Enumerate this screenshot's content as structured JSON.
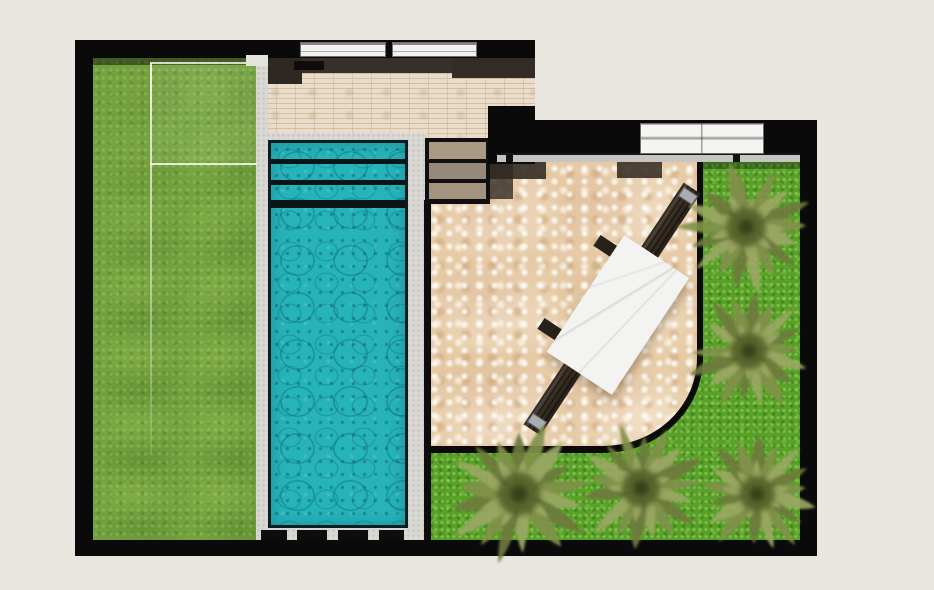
{
  "scene": {
    "kind": "architectural-landscape-plan-top-view",
    "background": "#e9e5df"
  },
  "palette": {
    "background": "#e9e5df",
    "wall": "#0a0a0a",
    "lawn": "#73a33e",
    "grass": "#57a226",
    "pool_water": "#26b3ba",
    "coping": "#dad9d4",
    "brick": "#e9ddca",
    "patio_stone": "#e6cba6",
    "threshold": "#c6c5c1",
    "table": "#f3f4f2",
    "trunk": "#3c3126",
    "palm_dark": "#6d7a3c",
    "palm_mid": "#81904a",
    "palm_light": "#9aa763",
    "palm_center": "#46511f",
    "facade_shadow": "#37302a",
    "step_tan": "#a39580"
  },
  "layout": {
    "wall_left": [
      75,
      40,
      18,
      516
    ],
    "wall_top": [
      75,
      40,
      460,
      18
    ],
    "wall_bottom": [
      75,
      540,
      742,
      16
    ],
    "wall_right": [
      800,
      120,
      17,
      436
    ],
    "wall_wing_top": [
      490,
      120,
      327,
      42
    ],
    "wall_corner": [
      488,
      106,
      47,
      58
    ],
    "lawn": [
      93,
      58,
      164,
      482
    ],
    "lawn_shadow": [
      93,
      58,
      164,
      7
    ],
    "bed_overlay": [
      150,
      63,
      107,
      101
    ],
    "bed_line_v": [
      150,
      63,
      2,
      392
    ],
    "bed_line_top": [
      150,
      62,
      107,
      2
    ],
    "bed_line_h": [
      150,
      163,
      107,
      2
    ],
    "coping_upper": [
      256,
      56,
      12,
      80
    ],
    "corner_paver": [
      246,
      55,
      22,
      11
    ],
    "brick": [
      257,
      58,
      278,
      80
    ],
    "brick_sill": [
      257,
      133,
      170,
      5
    ],
    "pool_coping": [
      256,
      133,
      171,
      410
    ],
    "pool_water": [
      268,
      140,
      140,
      388
    ],
    "steps_block": [
      425,
      138,
      65,
      66
    ],
    "grass": [
      427,
      162,
      373,
      378
    ],
    "grass_top_shadow": [
      703,
      162,
      97,
      7
    ],
    "patio": [
      427,
      162,
      276,
      291
    ],
    "patio_edge_line": [
      424,
      200,
      7,
      340
    ],
    "threshold": [
      497,
      153,
      303,
      9
    ],
    "door_right": [
      640,
      123,
      124,
      31
    ],
    "door_top_1": [
      300,
      42,
      86,
      15
    ],
    "door_top_2": [
      392,
      42,
      85,
      15
    ]
  },
  "facade_shadows": [
    {
      "rect": [
        268,
        58,
        267,
        15
      ],
      "color": "#37302a"
    },
    {
      "rect": [
        268,
        58,
        34,
        26
      ],
      "color": "#2e2823"
    },
    {
      "rect": [
        452,
        58,
        83,
        20
      ],
      "color": "#332c26"
    },
    {
      "rect": [
        294,
        61,
        30,
        9
      ],
      "color": "#0f0d0b"
    }
  ],
  "patio_shadows": [
    {
      "rect": [
        490,
        162,
        56,
        17
      ],
      "color": "rgba(48,40,31,0.88)"
    },
    {
      "rect": [
        490,
        162,
        23,
        37
      ],
      "color": "rgba(48,40,31,0.80)"
    },
    {
      "rect": [
        617,
        162,
        45,
        16
      ],
      "color": "rgba(48,40,31,0.85)"
    }
  ],
  "pool": {
    "lane_lines": [
      {
        "y": 16,
        "h": 5
      },
      {
        "y": 37,
        "h": 5
      },
      {
        "y": 57,
        "h": 8
      }
    ],
    "bottom_dashes": [
      [
        261,
        530,
        26,
        10
      ],
      [
        297,
        530,
        30,
        10
      ],
      [
        338,
        530,
        30,
        10
      ],
      [
        379,
        530,
        25,
        10
      ]
    ],
    "step_treads": [
      {
        "rect": [
          429,
          142,
          57,
          17
        ],
        "color": "#a89a85"
      },
      {
        "rect": [
          429,
          163,
          57,
          16
        ],
        "color": "#97897a"
      },
      {
        "rect": [
          429,
          183,
          57,
          16
        ],
        "color": "#a2947e"
      }
    ]
  },
  "door_stops": [
    [
      506,
      154,
      7,
      8
    ],
    [
      733,
      154,
      7,
      8
    ]
  ],
  "furniture": {
    "trunk": {
      "cx": 612,
      "cy": 309,
      "w": 20,
      "h": 290,
      "rot": 33.5
    },
    "trunk_caps": [
      {
        "cx": 688,
        "cy": 196,
        "w": 17,
        "h": 11,
        "rot": 33.5
      },
      {
        "cx": 537,
        "cy": 422,
        "w": 17,
        "h": 11,
        "rot": 33.5
      }
    ],
    "side_stubs": [
      {
        "cx": 607,
        "cy": 247,
        "w": 24,
        "h": 13,
        "rot": 33.5
      },
      {
        "cx": 551,
        "cy": 330,
        "w": 24,
        "h": 13,
        "rot": 33.5
      }
    ],
    "table": {
      "cx": 618,
      "cy": 315,
      "w": 78,
      "h": 140,
      "rot": 33.5
    }
  },
  "garden": {
    "palms": [
      {
        "x": 746,
        "y": 227,
        "r": 66
      },
      {
        "x": 749,
        "y": 351,
        "r": 62
      },
      {
        "x": 641,
        "y": 488,
        "r": 64
      },
      {
        "x": 757,
        "y": 494,
        "r": 60
      },
      {
        "x": 519,
        "y": 494,
        "r": 72
      }
    ],
    "frond_count": 17
  }
}
